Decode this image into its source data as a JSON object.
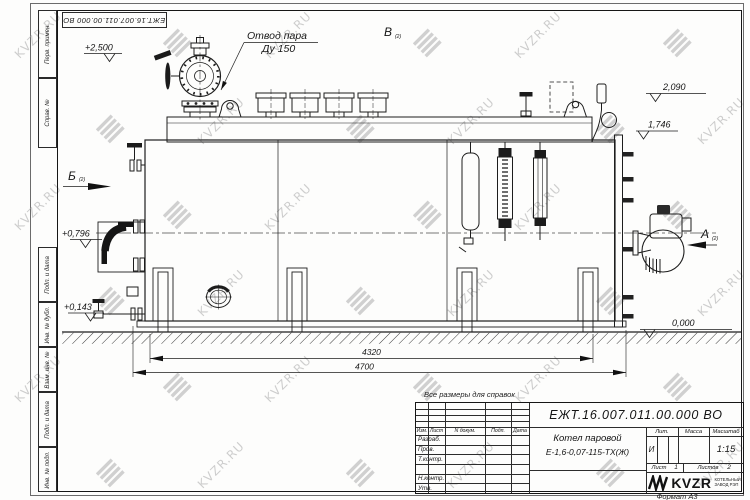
{
  "watermark": {
    "text": "KVZR.RU"
  },
  "top_stamp": {
    "designation": "ЕЖТ.16.007.011.00.000  ВО"
  },
  "side_stamp": {
    "labels": [
      "Перв. примен.",
      "Справ. №",
      "Подп. и дата",
      "Инв. № дубл.",
      "Взам. инв. №",
      "Подп. и дата",
      "Инв. № подл."
    ]
  },
  "drawing": {
    "callout_line1": "Отвод пара",
    "callout_line2": "Ду 150",
    "views": {
      "a": "А",
      "b": "Б",
      "v": "В",
      "sheet_ref": "(2)"
    },
    "elevations": {
      "e2500": "+2,500",
      "e0796": "+0,796",
      "e0143": "+0,143",
      "e2090": "2,090",
      "e1746": "1,746",
      "e0000": "0,000"
    },
    "dimensions": {
      "d4320": "4320",
      "d4700": "4700"
    }
  },
  "title_block": {
    "note": "Все размеры для справок",
    "designation": "ЕЖТ.16.007.011.00.000  ВО",
    "name_line1": "Котел паровой",
    "name_line2": "Е-1,6-0,07-115-ТХ(Ж)",
    "rev_header": [
      "Изм.",
      "Лист",
      "N докум.",
      "Подп.",
      "Дата"
    ],
    "sign_rows": [
      "Разраб.",
      "Пров.",
      "Т.контр.",
      "",
      "Н.контр.",
      "Утв."
    ],
    "lit_label": "Лит.",
    "mass_label": "Масса",
    "scale_label": "Масштаб",
    "lit_value": "И",
    "scale_value": "1:15",
    "sheet_label": "Лист",
    "sheet_value": "1",
    "sheets_label": "Листов",
    "sheets_value": "2",
    "company": {
      "logo": "KVZR",
      "tagline1": "КОТЕЛЬНЫЙ",
      "tagline2": "ЗАВОД РЭП"
    },
    "format_note": "Формат А3"
  }
}
